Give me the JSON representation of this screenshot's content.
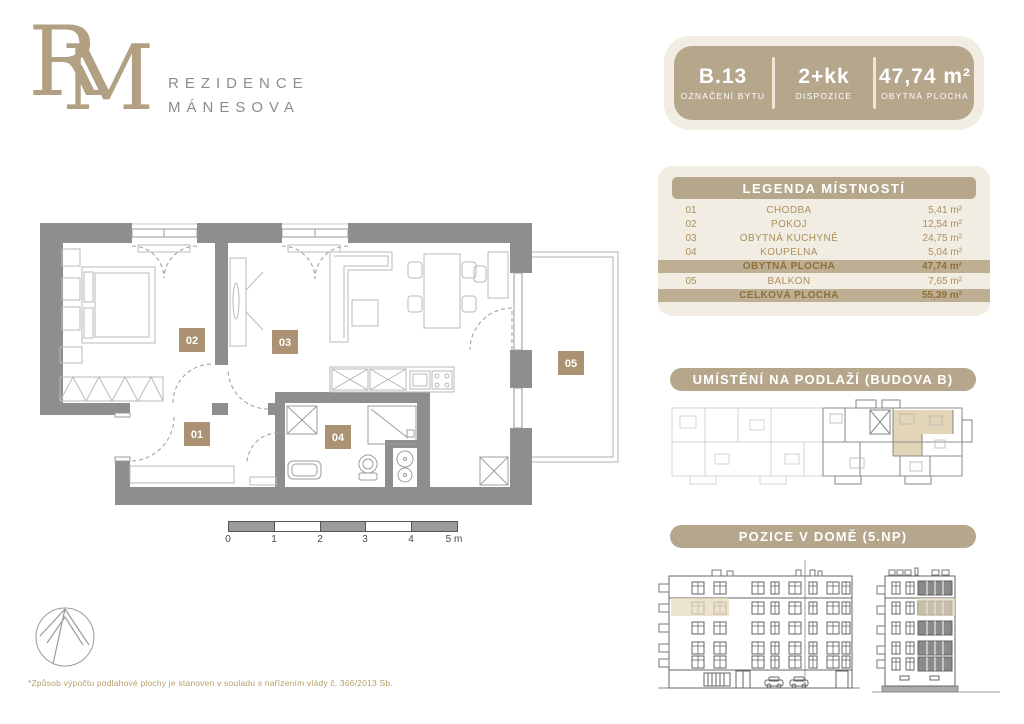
{
  "brand": {
    "monogram_r": "R",
    "monogram_m": "M",
    "name_line1": "REZIDENCE",
    "name_line2": "MÁNESOVA"
  },
  "info_card": {
    "unit": {
      "value": "B.13",
      "label": "OZNAČENÍ BYTU"
    },
    "layout": {
      "value": "2+kk",
      "label": "DISPOZICE"
    },
    "area": {
      "value": "47,74 m²",
      "label": "OBYTNÁ PLOCHA"
    }
  },
  "legend": {
    "title": "LEGENDA MÍSTNOSTÍ",
    "rows": [
      {
        "no": "01",
        "name": "CHODBA",
        "area": "5,41 m²"
      },
      {
        "no": "02",
        "name": "POKOJ",
        "area": "12,54 m²"
      },
      {
        "no": "03",
        "name": "OBYTNÁ KUCHYNĚ",
        "area": "24,75 m²"
      },
      {
        "no": "04",
        "name": "KOUPELNA",
        "area": "5,04 m²"
      }
    ],
    "subtotal": {
      "name": "OBYTNÁ PLOCHA",
      "area": "47,74 m²"
    },
    "balcony_row": {
      "no": "05",
      "name": "BALKON",
      "area": "7,65 m²"
    },
    "total": {
      "name": "CELKOVÁ PLOCHA",
      "area": "55,39 m²"
    }
  },
  "sections": {
    "floor_location": "UMÍSTĚNÍ NA PODLAŽÍ (BUDOVA B)",
    "house_position": "POZICE V DOMĚ (5.NP)"
  },
  "plan": {
    "room_labels": {
      "r01": "01",
      "r02": "02",
      "r03": "03",
      "r04": "04",
      "r05": "05"
    },
    "scale_ticks": [
      "0",
      "1",
      "2",
      "3",
      "4",
      "5 m"
    ],
    "footnote": "*Způsob výpočtu podlahové plochy je stanoven v souladu s nařízením vlády č. 366/2013 Sb."
  },
  "colors": {
    "tan": "#b5a68c",
    "cream": "#f2ede3",
    "band": "#bdae94",
    "gold_text": "#ab8f5d",
    "band_text": "#8e7139",
    "wall": "#8e8e8e",
    "highlight": "#e7dbbd",
    "label_box": "#ab9273"
  }
}
